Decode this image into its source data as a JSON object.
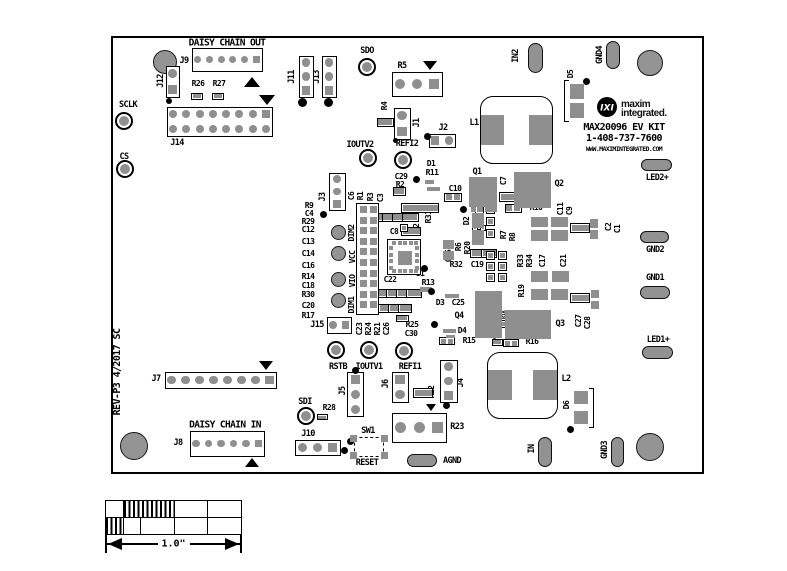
{
  "figure": {
    "width": 787,
    "height": 571,
    "type": "pcb-silkscreen-top-view"
  },
  "colors": {
    "pad_gray": "#8f8f8f",
    "silkscreen": "#000000",
    "background": "#ffffff"
  },
  "board": {
    "x": 111,
    "y": 36,
    "w": 593,
    "h": 438
  },
  "logo": {
    "glyph": "IXI",
    "line1": "maxim",
    "line2": "integrated."
  },
  "title_block": {
    "kit_name": "MAX20096 EV KIT",
    "phone": "1-408-737-7600",
    "url": "WWW.MAXIMINTEGRATED.COM",
    "revision": "REV-P3 4/2017 SC"
  },
  "scalebar": {
    "x": 105,
    "y": 500,
    "w": 137,
    "h": 35,
    "label": "1.0\"",
    "rows": [
      [
        {
          "w": 0.125,
          "hatch": false
        },
        {
          "w": 0.375,
          "hatch": true
        },
        {
          "w": 0.25,
          "hatch": false
        },
        {
          "w": 0.25,
          "hatch": false
        }
      ],
      [
        {
          "w": 0.125,
          "hatch": true
        },
        {
          "w": 0.125,
          "hatch": false
        },
        {
          "w": 0.25,
          "hatch": false
        },
        {
          "w": 0.25,
          "hatch": false
        },
        {
          "w": 0.25,
          "hatch": false
        }
      ]
    ],
    "arrow": {
      "x1": 105,
      "x2": 242,
      "y": 544
    }
  },
  "labels": [
    [
      "DAISY CHAIN OUT",
      227,
      43,
      0,
      9.5
    ],
    [
      "J9",
      184,
      61
    ],
    [
      "R26",
      198,
      84,
      0,
      8
    ],
    [
      "R27",
      219,
      84,
      0,
      8
    ],
    [
      "SCLK",
      128,
      105
    ],
    [
      "J14",
      177,
      143
    ],
    [
      "CS",
      124,
      157
    ],
    [
      "J12",
      161,
      81,
      1
    ],
    [
      "J11",
      292,
      77,
      1
    ],
    [
      "J13",
      317,
      77,
      1
    ],
    [
      "SDO",
      367,
      51
    ],
    [
      "R5",
      402,
      66
    ],
    [
      "R4",
      385,
      106,
      1,
      8
    ],
    [
      "J1",
      417,
      123,
      1
    ],
    [
      "J2",
      443,
      128
    ],
    [
      "IOUTV2",
      360,
      145
    ],
    [
      "REFI2",
      407,
      144
    ],
    [
      "IN2",
      516,
      56,
      1
    ],
    [
      "GND4",
      600,
      55,
      1
    ],
    [
      "D5",
      571,
      74,
      1,
      8
    ],
    [
      "L1",
      474,
      123
    ],
    [
      "MAX20096 EV KIT",
      624,
      128,
      0,
      10
    ],
    [
      "1-408-737-7600",
      624,
      139,
      0,
      10
    ],
    [
      "WWW.MAXIMINTEGRATED.COM",
      624,
      149,
      0,
      6.5
    ],
    [
      "LED2+",
      657,
      178
    ],
    [
      "GND2",
      655,
      250
    ],
    [
      "GND1",
      655,
      278
    ],
    [
      "LED1+",
      658,
      340
    ],
    [
      "C29",
      401,
      177,
      0,
      8
    ],
    [
      "D1",
      431,
      164,
      0,
      8
    ],
    [
      "R11",
      432,
      173,
      0,
      8
    ],
    [
      "R2",
      400,
      185,
      0,
      8
    ],
    [
      "Q1",
      477,
      172
    ],
    [
      "C10",
      455,
      189,
      0,
      8
    ],
    [
      "C7",
      504,
      181,
      1,
      8
    ],
    [
      "Q2",
      559,
      184
    ],
    [
      "R10",
      536,
      208,
      0,
      8
    ],
    [
      "C11",
      561,
      209,
      1,
      8
    ],
    [
      "C9",
      570,
      211,
      1,
      8
    ],
    [
      "C2",
      609,
      227,
      1,
      8
    ],
    [
      "C1",
      618,
      229,
      1,
      8
    ],
    [
      "D2",
      467,
      221,
      1,
      8
    ],
    [
      "C5",
      480,
      224,
      0,
      5.5
    ],
    [
      "R7",
      504,
      235,
      1,
      8
    ],
    [
      "R8",
      513,
      237,
      1,
      8
    ],
    [
      "R6",
      459,
      247,
      1,
      8
    ],
    [
      "R20",
      468,
      248,
      1,
      8
    ],
    [
      "C15",
      449,
      256,
      1,
      8
    ],
    [
      "R31",
      429,
      217,
      1,
      8
    ],
    [
      "R12",
      417,
      230,
      1,
      8
    ],
    [
      "C6",
      352,
      196,
      1,
      8
    ],
    [
      "R1",
      361,
      196,
      1,
      8
    ],
    [
      "R3",
      371,
      197,
      1,
      8
    ],
    [
      "C3",
      381,
      198,
      1,
      8
    ],
    [
      "J3",
      323,
      197,
      1
    ],
    [
      "C8",
      394,
      232,
      0,
      8
    ],
    [
      "R32",
      456,
      265,
      0,
      8
    ],
    [
      "C19",
      477,
      265,
      0,
      8
    ],
    [
      "R33",
      521,
      261,
      1,
      8
    ],
    [
      "R34",
      530,
      261,
      1,
      8
    ],
    [
      "C17",
      543,
      261,
      1,
      8
    ],
    [
      "C21",
      564,
      261,
      1,
      8
    ],
    [
      "U1",
      420,
      274,
      0,
      8
    ],
    [
      "R13",
      428,
      283,
      0,
      8
    ],
    [
      "C22",
      390,
      280,
      0,
      8
    ],
    [
      "DIM2",
      352,
      233,
      1,
      8
    ],
    [
      "VCC",
      353,
      257,
      1,
      8
    ],
    [
      "VIO",
      353,
      281,
      1,
      8
    ],
    [
      "DIM1",
      352,
      305,
      1,
      8
    ],
    [
      "R9",
      309,
      206,
      0,
      8
    ],
    [
      "C4",
      309,
      214,
      0,
      8
    ],
    [
      "R29",
      308,
      222,
      0,
      8
    ],
    [
      "C12",
      308,
      230,
      0,
      8
    ],
    [
      "C13",
      308,
      242,
      0,
      8
    ],
    [
      "C14",
      308,
      254,
      0,
      8
    ],
    [
      "C16",
      308,
      266,
      0,
      8
    ],
    [
      "R14",
      308,
      277,
      0,
      8
    ],
    [
      "C18",
      308,
      286,
      0,
      8
    ],
    [
      "R30",
      308,
      295,
      0,
      8
    ],
    [
      "C20",
      308,
      306,
      0,
      8
    ],
    [
      "R17",
      308,
      316,
      0,
      8
    ],
    [
      "D3",
      440,
      303,
      0,
      8
    ],
    [
      "C25",
      458,
      303,
      0,
      8
    ],
    [
      "R19",
      522,
      291,
      1,
      8
    ],
    [
      "R18",
      505,
      315,
      1,
      5.5
    ],
    [
      "C24",
      496,
      335,
      1,
      5.5
    ],
    [
      "Q4",
      459,
      316
    ],
    [
      "D4",
      462,
      331,
      0,
      8
    ],
    [
      "R15",
      469,
      341,
      0,
      8
    ],
    [
      "R16",
      532,
      342,
      0,
      8
    ],
    [
      "Q3",
      560,
      324
    ],
    [
      "C27",
      579,
      321,
      1,
      8
    ],
    [
      "C28",
      588,
      323,
      1,
      8
    ],
    [
      "C23",
      360,
      329,
      1,
      8
    ],
    [
      "R24",
      369,
      329,
      1,
      8
    ],
    [
      "R21",
      378,
      329,
      1,
      8
    ],
    [
      "C26",
      387,
      329,
      1,
      8
    ],
    [
      "R25",
      412,
      325,
      0,
      8
    ],
    [
      "C30",
      411,
      334,
      0,
      8
    ],
    [
      "J15",
      317,
      325
    ],
    [
      "RSTB",
      338,
      367
    ],
    [
      "IOUTV1",
      369,
      367
    ],
    [
      "REFI1",
      410,
      367
    ],
    [
      "J5",
      343,
      391,
      1
    ],
    [
      "J6",
      386,
      384,
      1
    ],
    [
      "R22",
      432,
      392,
      1,
      8
    ],
    [
      "J4",
      461,
      383,
      1
    ],
    [
      "SDI",
      305,
      402
    ],
    [
      "R28",
      329,
      408,
      0,
      8
    ],
    [
      "J10",
      308,
      434
    ],
    [
      "SW1",
      368,
      431
    ],
    [
      "RESET",
      367,
      463
    ],
    [
      "R23",
      457,
      427
    ],
    [
      "AGND",
      452,
      461
    ],
    [
      "J7",
      156,
      379
    ],
    [
      "DAISY CHAIN IN",
      225,
      425,
      0,
      9.5
    ],
    [
      "J8",
      178,
      443
    ],
    [
      "L2",
      566,
      379
    ],
    [
      "D6",
      567,
      405,
      1,
      8
    ],
    [
      "IN",
      532,
      449,
      1
    ],
    [
      "GND3",
      605,
      450,
      1
    ],
    [
      "REV-P3 4/2017 SC",
      118,
      372,
      1,
      10
    ]
  ],
  "testpoints": [
    {
      "n": "SCLK",
      "x": 124,
      "y": 121
    },
    {
      "n": "CS",
      "x": 125,
      "y": 169
    },
    {
      "n": "SDO",
      "x": 367,
      "y": 67
    },
    {
      "n": "IOUTV2",
      "x": 368,
      "y": 158
    },
    {
      "n": "REFI2",
      "x": 403,
      "y": 160
    },
    {
      "n": "RSTB",
      "x": 336,
      "y": 350
    },
    {
      "n": "IOUTV1",
      "x": 369,
      "y": 350
    },
    {
      "n": "REFI1",
      "x": 404,
      "y": 351
    },
    {
      "n": "SDI",
      "x": 306,
      "y": 416
    }
  ],
  "mounts": [
    [
      165,
      62,
      12
    ],
    [
      650,
      63,
      13
    ],
    [
      134,
      446,
      14
    ],
    [
      650,
      447,
      14
    ]
  ],
  "vias": [
    [
      338,
      232,
      7.5
    ],
    [
      338,
      253,
      7.5
    ],
    [
      338,
      279,
      7.5
    ],
    [
      338,
      300,
      7.5
    ]
  ],
  "ovals": [
    {
      "n": "pad-in2",
      "x": 535,
      "y": 58,
      "w": 15,
      "h": 30
    },
    {
      "n": "pad-gnd4",
      "x": 613,
      "y": 55,
      "w": 14,
      "h": 28
    },
    {
      "n": "pad-led2",
      "x": 656,
      "y": 165,
      "w": 31,
      "h": 12
    },
    {
      "n": "pad-gnd2",
      "x": 654,
      "y": 237,
      "w": 29,
      "h": 12
    },
    {
      "n": "pad-gnd1",
      "x": 655,
      "y": 292,
      "w": 30,
      "h": 13
    },
    {
      "n": "pad-led1",
      "x": 657,
      "y": 352,
      "w": 31,
      "h": 13
    },
    {
      "n": "pad-agnd",
      "x": 422,
      "y": 460,
      "w": 30,
      "h": 13
    },
    {
      "n": "pad-in",
      "x": 545,
      "y": 452,
      "w": 14,
      "h": 30
    },
    {
      "n": "pad-gnd3",
      "x": 617,
      "y": 452,
      "w": 13,
      "h": 30
    }
  ],
  "headers": [
    {
      "n": "J9",
      "x": 192,
      "y": 48,
      "w": 71,
      "h": 24,
      "r": 1,
      "c": 6,
      "sq": 5
    },
    {
      "n": "J14",
      "x": 167,
      "y": 107,
      "w": 106,
      "h": 30,
      "r": 2,
      "c": 8,
      "sq": 7
    },
    {
      "n": "J12",
      "x": 166,
      "y": 66,
      "w": 14,
      "h": 32,
      "r": 2,
      "c": 1,
      "sq": 1
    },
    {
      "n": "J11",
      "x": 299,
      "y": 56,
      "w": 15,
      "h": 42,
      "r": 3,
      "c": 1,
      "sq": 2
    },
    {
      "n": "J13",
      "x": 322,
      "y": 56,
      "w": 15,
      "h": 42,
      "r": 3,
      "c": 1,
      "sq": 2
    },
    {
      "n": "R5",
      "x": 392,
      "y": 72,
      "w": 51,
      "h": 25,
      "r": 1,
      "c": 3,
      "sq": 2
    },
    {
      "n": "J1",
      "x": 394,
      "y": 108,
      "w": 17,
      "h": 32,
      "r": 2,
      "c": 1,
      "sq": 1
    },
    {
      "n": "J2",
      "x": 429,
      "y": 134,
      "w": 27,
      "h": 14,
      "r": 1,
      "c": 2,
      "sq": 0
    },
    {
      "n": "J3",
      "x": 329,
      "y": 173,
      "w": 17,
      "h": 38,
      "r": 3,
      "c": 1,
      "sq": 2
    },
    {
      "n": "J15",
      "x": 327,
      "y": 317,
      "w": 25,
      "h": 17,
      "r": 1,
      "c": 2,
      "sq": 1
    },
    {
      "n": "J5",
      "x": 347,
      "y": 372,
      "w": 17,
      "h": 45,
      "r": 3,
      "c": 1,
      "sq": 0
    },
    {
      "n": "J6",
      "x": 392,
      "y": 372,
      "w": 17,
      "h": 31,
      "r": 2,
      "c": 1,
      "sq": 0
    },
    {
      "n": "J4",
      "x": 440,
      "y": 360,
      "w": 18,
      "h": 43,
      "r": 3,
      "c": 1,
      "sq": 2
    },
    {
      "n": "R23",
      "x": 392,
      "y": 413,
      "w": 55,
      "h": 30,
      "r": 1,
      "c": 3,
      "sq": 2
    },
    {
      "n": "J10",
      "x": 295,
      "y": 440,
      "w": 46,
      "h": 16,
      "r": 1,
      "c": 3,
      "sq": 2
    },
    {
      "n": "J7",
      "x": 165,
      "y": 372,
      "w": 112,
      "h": 17,
      "r": 1,
      "c": 8,
      "sq": 7
    },
    {
      "n": "J8",
      "x": 190,
      "y": 431,
      "w": 75,
      "h": 26,
      "r": 1,
      "c": 6,
      "sq": 5
    }
  ],
  "passives": [
    [
      197,
      96,
      0,
      12,
      7
    ],
    [
      218,
      96,
      0,
      12,
      7
    ],
    [
      385,
      122,
      1,
      9,
      17
    ],
    [
      399,
      191,
      1,
      9,
      13
    ],
    [
      420,
      208,
      1,
      10,
      38
    ],
    [
      411,
      231,
      1,
      9,
      20
    ],
    [
      453,
      197,
      0,
      18,
      9
    ],
    [
      513,
      208,
      0,
      17,
      9
    ],
    [
      510,
      197,
      1,
      10,
      22
    ],
    [
      380,
      217,
      1,
      9,
      17
    ],
    [
      390,
      217,
      1,
      9,
      17
    ],
    [
      400,
      217,
      1,
      9,
      17
    ],
    [
      410,
      217,
      1,
      9,
      17
    ],
    [
      384,
      293,
      1,
      9,
      16
    ],
    [
      394,
      293,
      1,
      9,
      16
    ],
    [
      404,
      293,
      1,
      9,
      16
    ],
    [
      414,
      293,
      1,
      9,
      16
    ],
    [
      385,
      308,
      1,
      9,
      14
    ],
    [
      395,
      308,
      1,
      9,
      14
    ],
    [
      405,
      308,
      1,
      9,
      14
    ],
    [
      402,
      318,
      0,
      13,
      7
    ],
    [
      478,
      253,
      1,
      9,
      16
    ],
    [
      489,
      253,
      1,
      9,
      16
    ],
    [
      423,
      393,
      1,
      10,
      20
    ],
    [
      504,
      324,
      1,
      8,
      14
    ],
    [
      497,
      342,
      0,
      11,
      7
    ],
    [
      511,
      343,
      0,
      16,
      8
    ],
    [
      447,
      341,
      0,
      16,
      8
    ],
    [
      580,
      228,
      1,
      10,
      20
    ],
    [
      580,
      298,
      1,
      10,
      20
    ],
    [
      322,
      417,
      0,
      11,
      6
    ]
  ],
  "sqpads": [
    [
      479,
      209,
      9
    ],
    [
      490,
      209,
      9
    ],
    [
      479,
      221,
      9
    ],
    [
      490,
      221,
      9
    ],
    [
      479,
      233,
      9
    ],
    [
      490,
      233,
      9
    ],
    [
      490,
      255,
      9
    ],
    [
      502,
      255,
      9
    ],
    [
      490,
      266,
      9
    ],
    [
      502,
      266,
      9
    ],
    [
      490,
      277,
      9
    ],
    [
      502,
      277,
      9
    ],
    [
      475,
      228,
      6
    ],
    [
      483,
      228,
      6
    ],
    [
      404,
      228,
      8
    ]
  ],
  "bars": [
    [
      469,
      177,
      28,
      30
    ],
    [
      514,
      172,
      37,
      36
    ],
    [
      505,
      310,
      46,
      29
    ],
    [
      475,
      291,
      27,
      47
    ],
    [
      471,
      206,
      5,
      6
    ],
    [
      478,
      206,
      5,
      6
    ],
    [
      485,
      206,
      5,
      6
    ],
    [
      492,
      206,
      5,
      6
    ],
    [
      472,
      213,
      12,
      15
    ],
    [
      472,
      230,
      12,
      15
    ],
    [
      570,
      84,
      14,
      15
    ],
    [
      570,
      103,
      14,
      15
    ],
    [
      574,
      391,
      14,
      13
    ],
    [
      574,
      411,
      14,
      13
    ],
    [
      531,
      217,
      17,
      10
    ],
    [
      551,
      217,
      17,
      10
    ],
    [
      531,
      230,
      17,
      11
    ],
    [
      551,
      230,
      17,
      11
    ],
    [
      531,
      271,
      17,
      11
    ],
    [
      552,
      271,
      17,
      11
    ],
    [
      531,
      289,
      17,
      11
    ],
    [
      551,
      289,
      17,
      11
    ],
    [
      590,
      219,
      8,
      9
    ],
    [
      590,
      230,
      8,
      9
    ],
    [
      591,
      290,
      8,
      8
    ],
    [
      591,
      301,
      8,
      8
    ],
    [
      425,
      180,
      9,
      4
    ],
    [
      427,
      187,
      13,
      4
    ],
    [
      443,
      329,
      13,
      4
    ],
    [
      446,
      335,
      9,
      3
    ],
    [
      445,
      294,
      14,
      4
    ],
    [
      420,
      287,
      12,
      5
    ],
    [
      443,
      240,
      11,
      9
    ],
    [
      443,
      251,
      11,
      9
    ]
  ],
  "dots": [
    [
      169,
      101,
      3
    ],
    [
      302,
      102,
      4.5
    ],
    [
      328,
      102,
      4.5
    ],
    [
      395,
      140,
      2.5
    ],
    [
      427,
      136,
      3.5
    ],
    [
      416,
      179,
      3.5
    ],
    [
      323,
      214,
      3.5
    ],
    [
      463,
      209,
      3.5
    ],
    [
      424,
      268,
      3.5
    ],
    [
      431,
      291,
      3.5
    ],
    [
      434,
      324,
      3.5
    ],
    [
      355,
      370,
      3.5
    ],
    [
      446,
      405,
      3.5
    ],
    [
      350,
      441,
      3.5
    ],
    [
      344,
      450,
      3.5
    ],
    [
      586,
      81,
      3.5
    ],
    [
      570,
      429,
      3.5
    ]
  ],
  "tris": [
    [
      252,
      82,
      "up",
      16
    ],
    [
      267,
      100,
      "down",
      16
    ],
    [
      430,
      66,
      "down",
      15
    ],
    [
      266,
      366,
      "down",
      15
    ],
    [
      252,
      463,
      "up",
      15
    ],
    [
      431,
      408,
      "down",
      11
    ]
  ],
  "inductors": [
    {
      "n": "L1",
      "x": 480,
      "y": 96,
      "w": 73,
      "h": 68,
      "pw": 23,
      "ph": 30
    },
    {
      "n": "L2",
      "x": 487,
      "y": 352,
      "w": 71,
      "h": 67,
      "pw": 24,
      "ph": 30
    }
  ],
  "qfn": {
    "n": "U1",
    "x": 387,
    "y": 239,
    "w": 34,
    "h": 36,
    "edge": 5,
    "side": 4,
    "center": 14
  },
  "strip": {
    "x": 356,
    "y": 203,
    "w": 23,
    "h": 112,
    "cols": 2,
    "rows": 10
  },
  "switch": {
    "n": "SW1",
    "x": 354,
    "y": 437,
    "w": 30,
    "h": 20,
    "pads": [
      [
        350,
        435
      ],
      [
        381,
        435
      ],
      [
        350,
        452
      ],
      [
        381,
        452
      ]
    ],
    "ps": 7
  },
  "brackets": [
    {
      "x": 564,
      "y": 80,
      "w": 5,
      "h": 42,
      "side": "left"
    },
    {
      "x": 589,
      "y": 388,
      "w": 5,
      "h": 40,
      "side": "right"
    }
  ]
}
